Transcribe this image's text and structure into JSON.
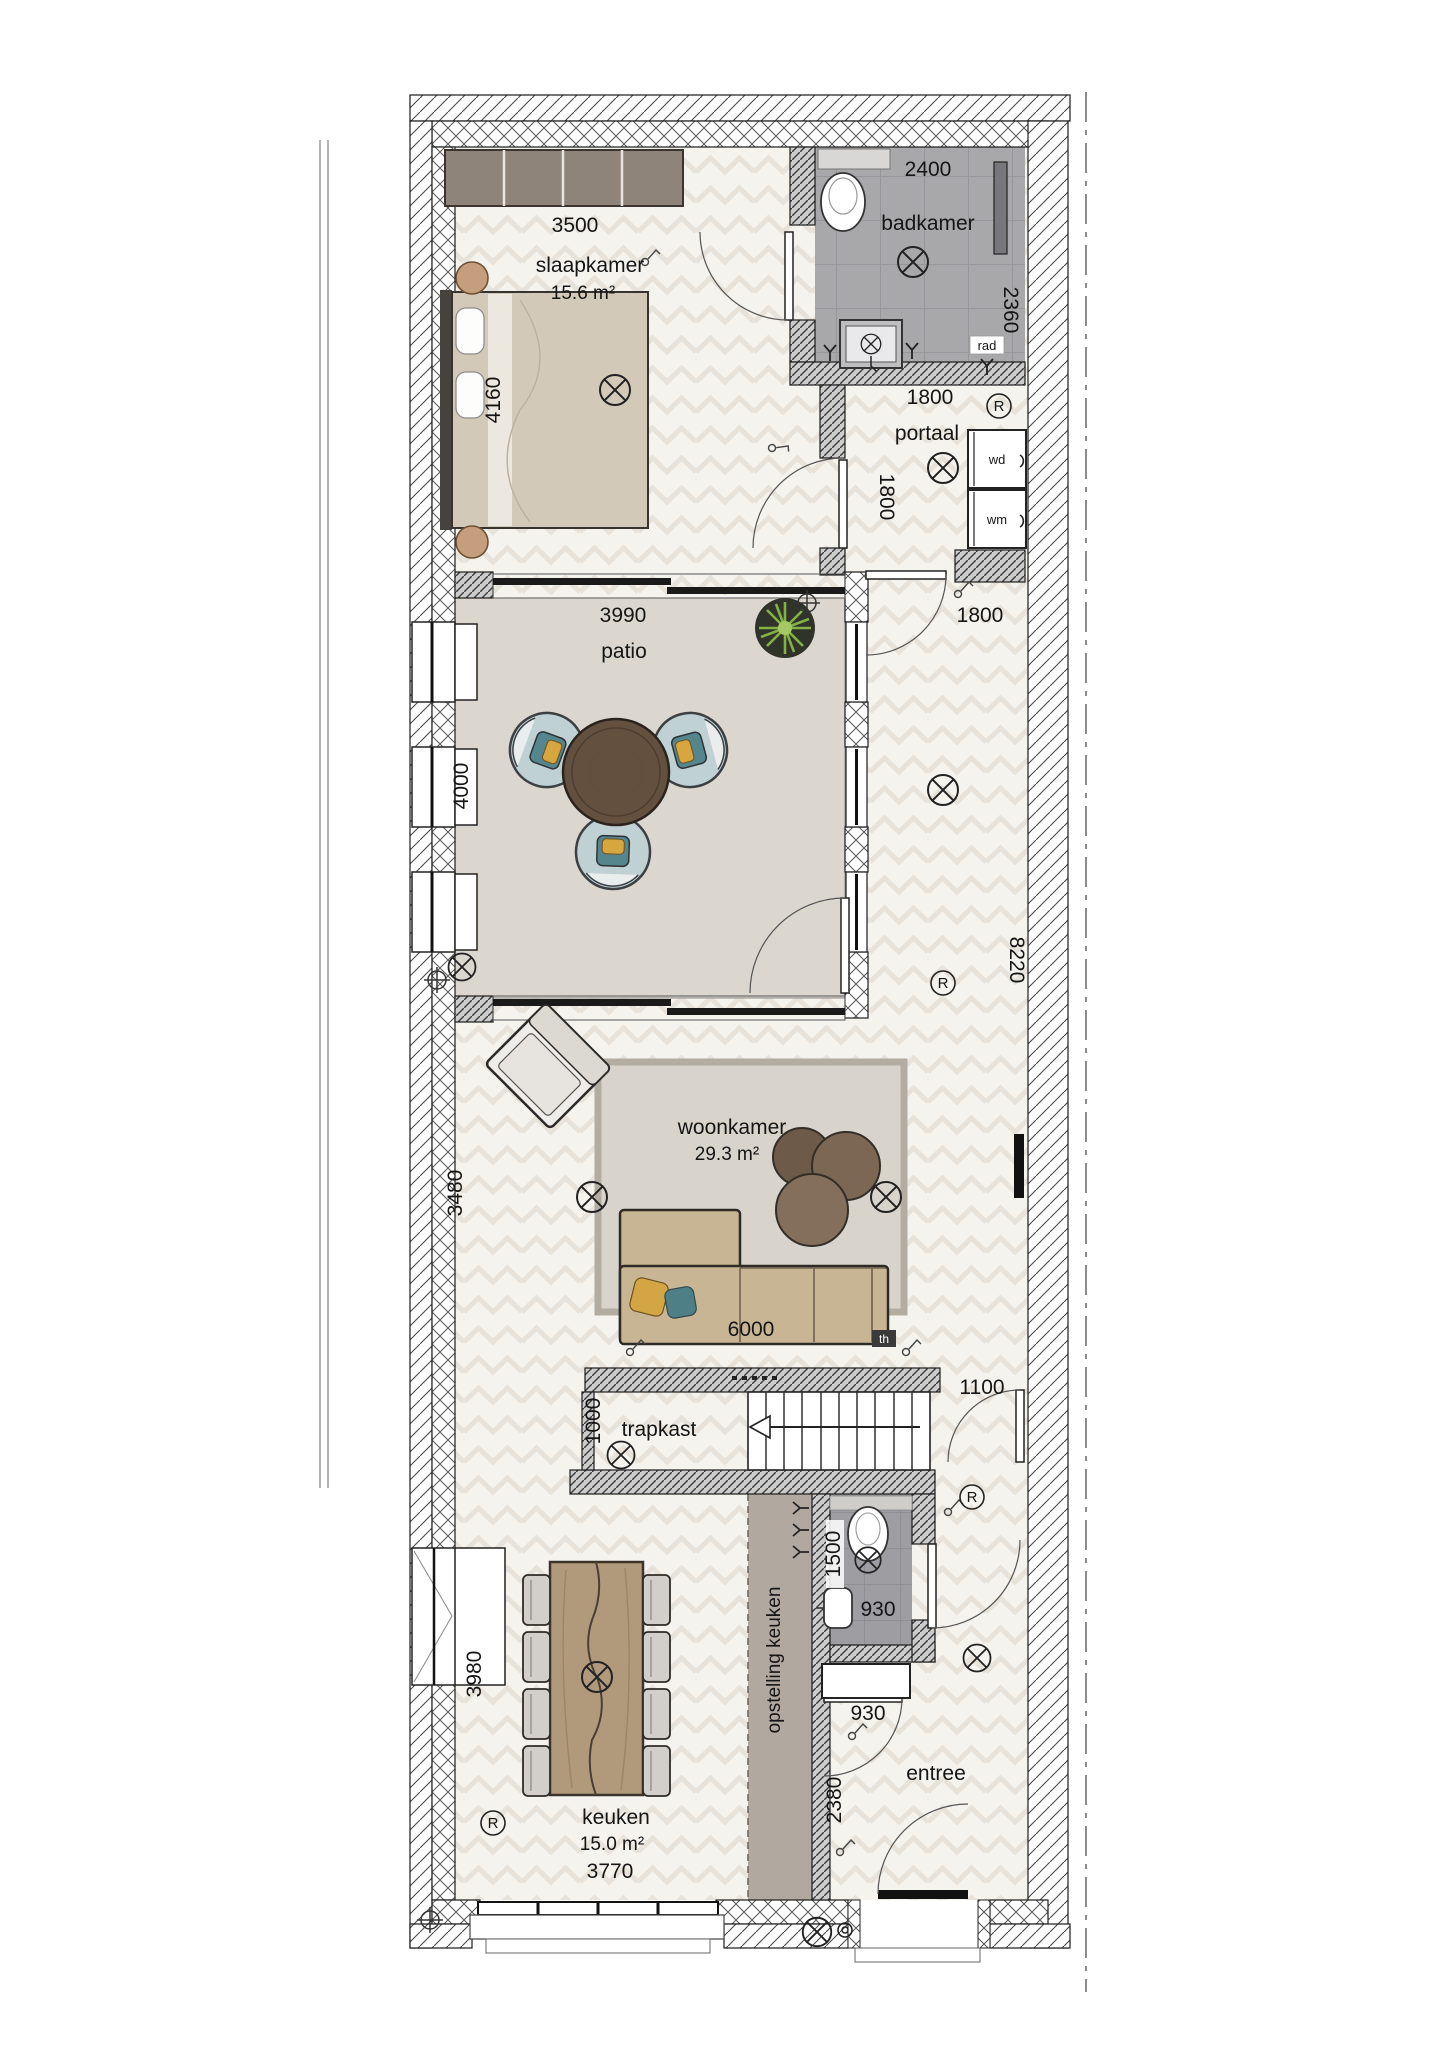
{
  "plan": {
    "rooms": {
      "slaapkamer": {
        "name": "slaapkamer",
        "area": "15.6 m²"
      },
      "badkamer": {
        "name": "badkamer"
      },
      "portaal": {
        "name": "portaal"
      },
      "patio": {
        "name": "patio"
      },
      "woonkamer": {
        "name": "woonkamer",
        "area": "29.3 m²"
      },
      "trapkast": {
        "name": "trapkast"
      },
      "keuken": {
        "name": "keuken",
        "area": "15.0 m²"
      },
      "opstelling_keuken": {
        "name": "opstelling keuken"
      },
      "entree": {
        "name": "entree"
      }
    },
    "dims": {
      "kast_slaapkamer": "3500",
      "bed": "4160",
      "badkamer_breedte": "2400",
      "badkamer_diepte": "2360",
      "badkamer_onder": "1800",
      "portaal_diepte": "1800",
      "hal_breedte": "1800",
      "patio_breedte": "3990",
      "patio_diepte": "4000",
      "hal_lengte": "8220",
      "woonkamer_zijde": "3480",
      "bank": "6000",
      "deur_opening": "1100",
      "trapkast_diepte": "1000",
      "wc_diepte": "1500",
      "wc_breedte": "930",
      "meterkast_breedte": "930",
      "entree_diepte": "2380",
      "keuken_zijde": "3980",
      "keuken_breedte": "3770"
    },
    "tags": {
      "rad": "rad",
      "wd": "wd",
      "wm": "wm",
      "th": "th",
      "r": "R"
    }
  }
}
